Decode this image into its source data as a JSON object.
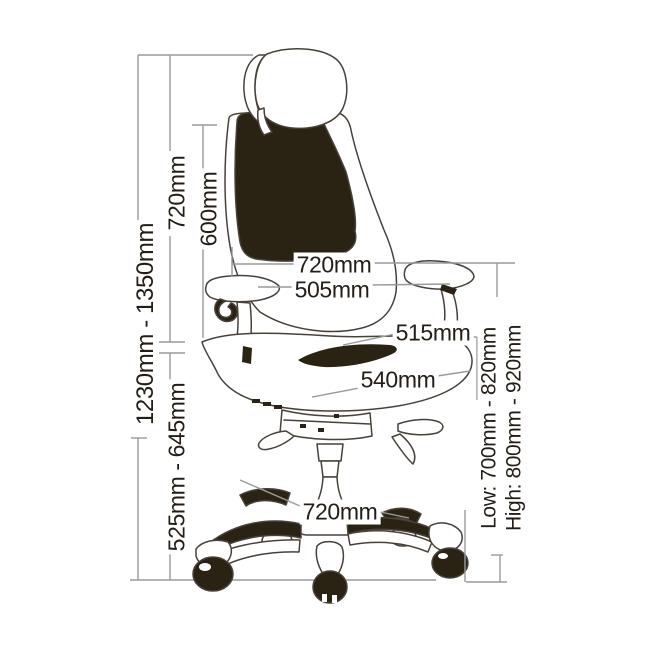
{
  "palette": {
    "ink": "#231d16",
    "chair_outline": "#48413a",
    "chair_dark_fill": "#2a2314",
    "dimension_line": "#9a9a9a",
    "background": "#ffffff"
  },
  "diagram": {
    "unit": "mm",
    "dimensions": {
      "overall_height": "1230mm - 1350mm",
      "headrest_top_to_seat": "720mm",
      "backrest_height": "600mm",
      "armrest_span_width": "720mm",
      "seat_width": "505mm",
      "back_width": "515mm",
      "seat_depth": "540mm",
      "seat_height_range": "525mm - 645mm",
      "base_width": "720mm",
      "armrest_floor_low": "Low: 700mm - 820mm",
      "armrest_floor_high": "High: 800mm - 920mm"
    }
  }
}
